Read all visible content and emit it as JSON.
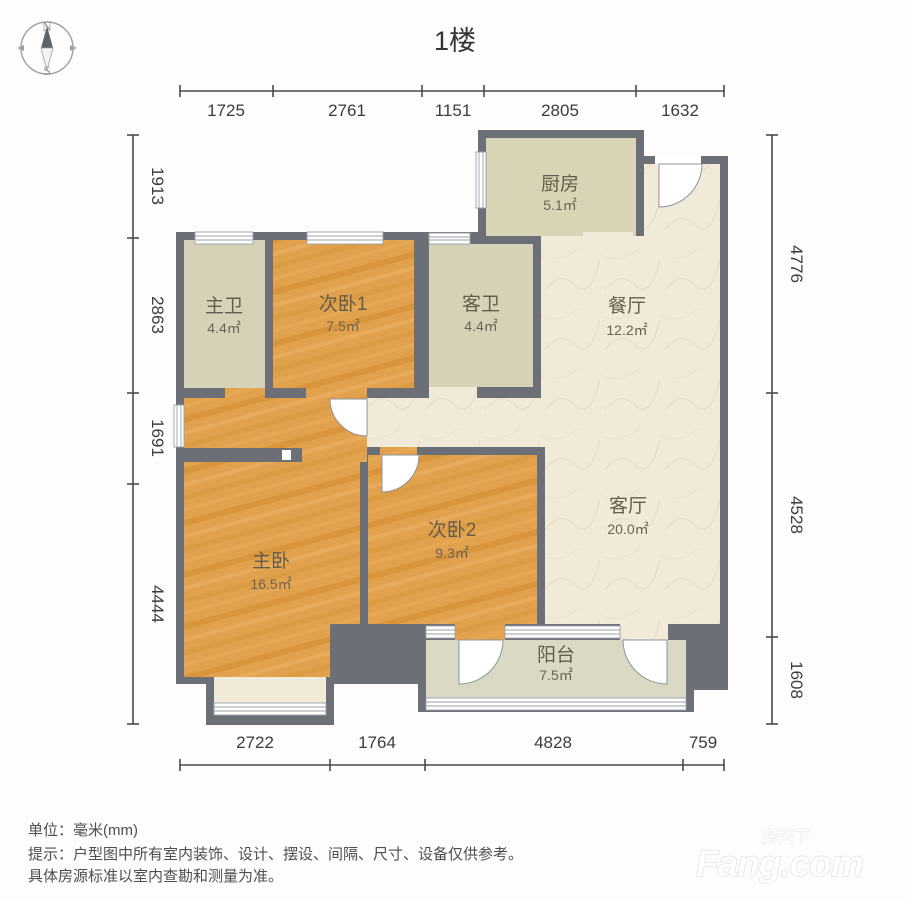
{
  "title": "1楼",
  "compass": {
    "north": "N",
    "south": "S"
  },
  "dimensions": {
    "unit": "mm",
    "top": [
      "1725",
      "2761",
      "1151",
      "2805",
      "1632"
    ],
    "bottom": [
      "2722",
      "1764",
      "4828",
      "759"
    ],
    "left": [
      "1913",
      "2863",
      "1691",
      "4444"
    ],
    "right": [
      "4776",
      "4528",
      "1608"
    ]
  },
  "rooms": {
    "kitchen": {
      "name": "厨房",
      "area": "5.1㎡"
    },
    "master_bath": {
      "name": "主卫",
      "area": "4.4㎡"
    },
    "bedroom1": {
      "name": "次卧1",
      "area": "7.5㎡"
    },
    "guest_bath": {
      "name": "客卫",
      "area": "4.4㎡"
    },
    "dining": {
      "name": "餐厅",
      "area": "12.2㎡"
    },
    "living": {
      "name": "客厅",
      "area": "20.0㎡"
    },
    "bedroom2": {
      "name": "次卧2",
      "area": "9.3㎡"
    },
    "master": {
      "name": "主卧",
      "area": "16.5㎡"
    },
    "balcony": {
      "name": "阳台",
      "area": "7.5㎡"
    }
  },
  "footer": {
    "unit_line": "单位：毫米(mm)",
    "note_line1": "提示：户型图中所有室内装饰、设计、摆设、间隔、尺寸、设备仅供参考。",
    "note_line2": "具体房源标准以室内查勘和测量为准。"
  },
  "watermark": {
    "cn": "房天下",
    "en": "Fang.com"
  },
  "colors": {
    "wall": "#6c7076",
    "wood_floor": "#e2a14d",
    "bath_floor": "#d6d2b8",
    "cream_floor": "#f1ead8",
    "balcony_floor": "#dadac4",
    "dimension_text": "#3c3c3c"
  }
}
